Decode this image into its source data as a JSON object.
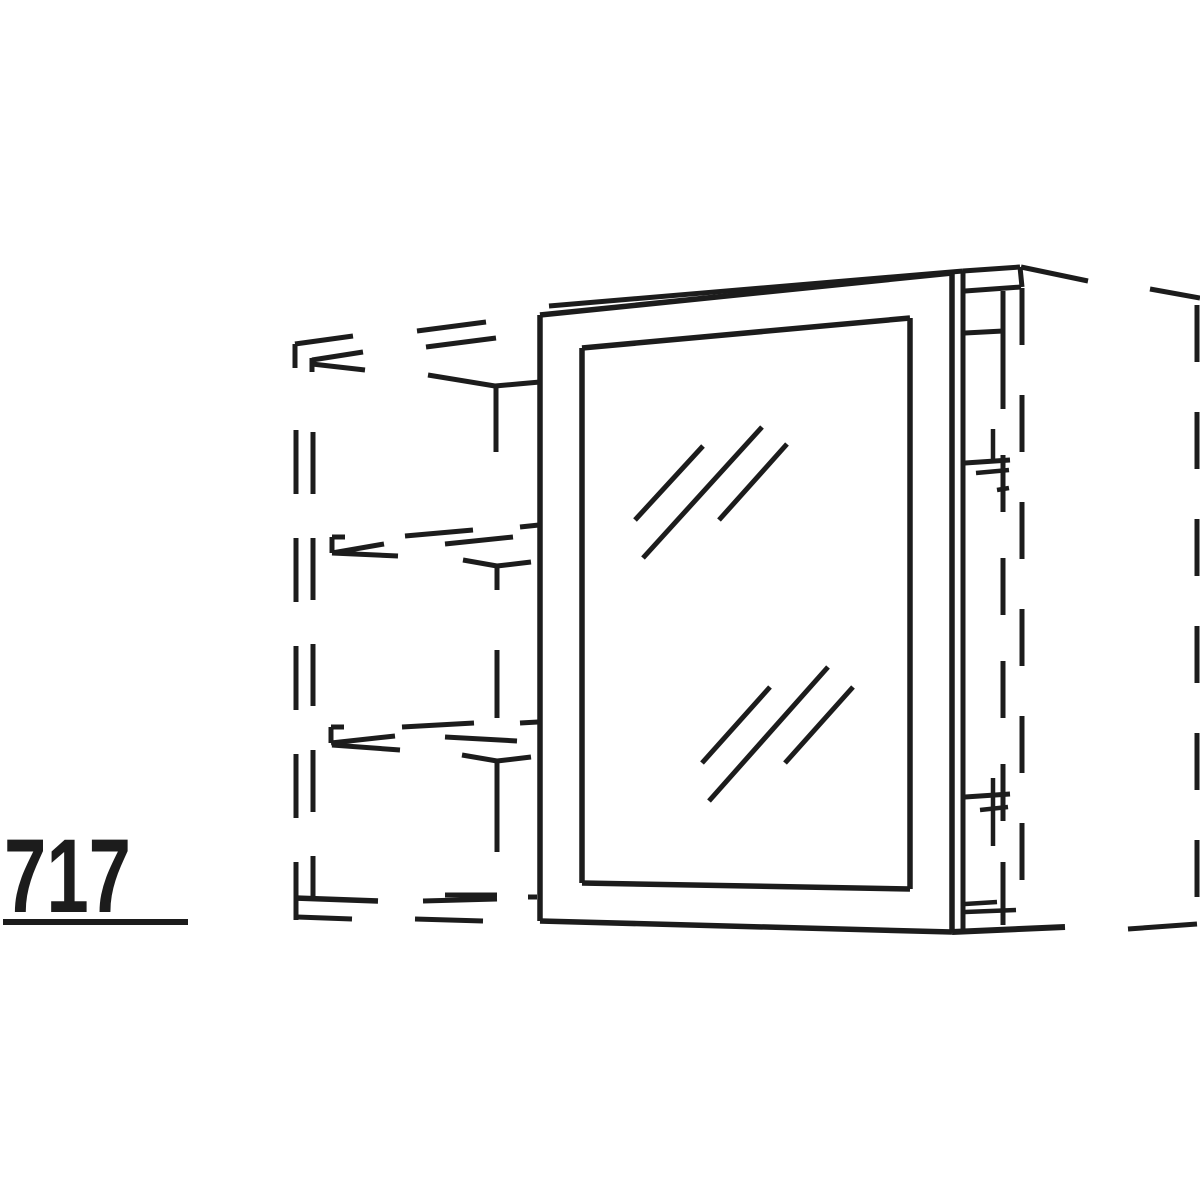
{
  "figure": {
    "description": "Perspective technical line drawing of a wall unit / cabinet with a glass door; neighbouring carcass, shelves and adjacent tall unit shown as dashed hidden lines",
    "dimension_label": "717",
    "background_color": "#ffffff",
    "line_color": "#1c1c1c"
  },
  "label": {
    "text": "717",
    "x": 4,
    "y": 912,
    "underline": {
      "x1": 3,
      "y1": 922,
      "x2": 188,
      "y2": 922,
      "w": 6
    }
  },
  "drawing": {
    "width": 1200,
    "height": 1200,
    "solid_lines": [
      [
        540,
        315,
        540,
        921,
        5.5
      ],
      [
        540,
        315,
        952,
        273,
        5.5
      ],
      [
        549,
        306,
        963,
        271,
        5
      ],
      [
        952,
        273,
        952,
        932,
        5.5
      ],
      [
        963,
        271,
        963,
        930,
        5
      ],
      [
        540,
        921,
        952,
        932,
        5.5
      ],
      [
        582,
        348,
        910,
        318,
        5.5
      ],
      [
        910,
        318,
        910,
        889,
        5.5
      ],
      [
        582,
        883,
        910,
        889,
        5.5
      ],
      [
        582,
        348,
        582,
        883,
        5.5
      ],
      [
        635,
        520,
        703,
        446,
        5
      ],
      [
        643,
        558,
        762,
        427,
        5
      ],
      [
        719,
        520,
        787,
        444,
        5
      ],
      [
        702,
        763,
        770,
        687,
        5
      ],
      [
        709,
        801,
        828,
        667,
        5
      ],
      [
        785,
        763,
        853,
        687,
        5
      ],
      [
        963,
        271,
        1020,
        267,
        5
      ],
      [
        965,
        291,
        1021,
        287,
        5
      ],
      [
        1020,
        267,
        1022,
        287,
        5
      ],
      [
        1021,
        267,
        1088,
        281,
        5
      ],
      [
        1003,
        291,
        1003,
        352,
        5
      ],
      [
        965,
        333,
        1003,
        331,
        5
      ],
      [
        965,
        463,
        1010,
        460,
        5
      ],
      [
        976,
        473,
        1009,
        470,
        4.5
      ],
      [
        997,
        490,
        1009,
        488,
        4.5
      ],
      [
        993,
        429,
        993,
        461,
        4.5
      ],
      [
        965,
        797,
        1010,
        794,
        5
      ],
      [
        980,
        810,
        1008,
        807,
        4.5
      ],
      [
        993,
        778,
        993,
        846,
        4.5
      ],
      [
        965,
        904,
        997,
        902,
        4.5
      ],
      [
        965,
        912,
        1016,
        910,
        4.5
      ],
      [
        1003,
        862,
        1003,
        925,
        5
      ],
      [
        952,
        932,
        1065,
        927,
        6
      ],
      [
        428,
        375,
        495,
        386,
        5
      ],
      [
        495,
        386,
        540,
        382,
        5
      ],
      [
        496,
        386,
        496,
        452,
        5
      ],
      [
        463,
        560,
        497,
        566,
        5
      ],
      [
        497,
        566,
        531,
        562,
        5
      ],
      [
        497,
        566,
        497,
        590,
        5
      ],
      [
        462,
        755,
        497,
        761,
        5
      ],
      [
        497,
        761,
        531,
        757,
        5
      ],
      [
        497,
        761,
        497,
        786,
        5
      ]
    ],
    "hidden_dash_segments": [
      [
        295,
        344,
        295,
        368
      ],
      [
        295,
        344,
        353,
        336
      ],
      [
        312,
        358,
        312,
        372
      ],
      [
        312,
        360,
        363,
        352
      ],
      [
        312,
        364,
        365,
        370
      ],
      [
        417,
        331,
        486,
        322
      ],
      [
        426,
        347,
        496,
        338
      ],
      [
        332,
        537,
        345,
        537
      ],
      [
        332,
        537,
        332,
        553
      ],
      [
        332,
        553,
        384,
        544
      ],
      [
        332,
        553,
        398,
        556
      ],
      [
        405,
        536,
        473,
        530
      ],
      [
        445,
        544,
        513,
        537
      ],
      [
        520,
        527,
        539,
        525
      ],
      [
        331,
        727,
        344,
        727
      ],
      [
        331,
        727,
        331,
        743
      ],
      [
        331,
        743,
        395,
        736
      ],
      [
        332,
        745,
        400,
        750
      ],
      [
        402,
        727,
        474,
        723
      ],
      [
        445,
        737,
        517,
        741
      ],
      [
        520,
        723,
        538,
        722
      ],
      [
        295,
        898,
        378,
        901,
        5.5
      ],
      [
        297,
        917,
        352,
        919
      ],
      [
        445,
        895,
        497,
        895
      ],
      [
        423,
        901,
        497,
        899
      ],
      [
        415,
        919,
        483,
        921
      ],
      [
        528,
        897,
        537,
        897
      ],
      [
        497,
        650,
        497,
        718
      ],
      [
        497,
        782,
        497,
        852
      ],
      [
        1150,
        289,
        1200,
        298
      ],
      [
        1128,
        929,
        1197,
        924
      ]
    ],
    "dashed_lines": [
      {
        "p": [
          296,
          430,
          296,
          920
        ],
        "dash": "64 44",
        "w": 5
      },
      {
        "p": [
          313,
          432,
          313,
          898
        ],
        "dash": "62 44",
        "w": 5
      },
      {
        "p": [
          1003,
          352,
          1003,
          862
        ],
        "dash": "57 46",
        "w": 5
      },
      {
        "p": [
          1022,
          288,
          1022,
          928
        ],
        "dash": "57 50",
        "w": 5
      },
      {
        "p": [
          1197,
          305,
          1197,
          922
        ],
        "dash": "57 50",
        "w": 5
      }
    ]
  }
}
